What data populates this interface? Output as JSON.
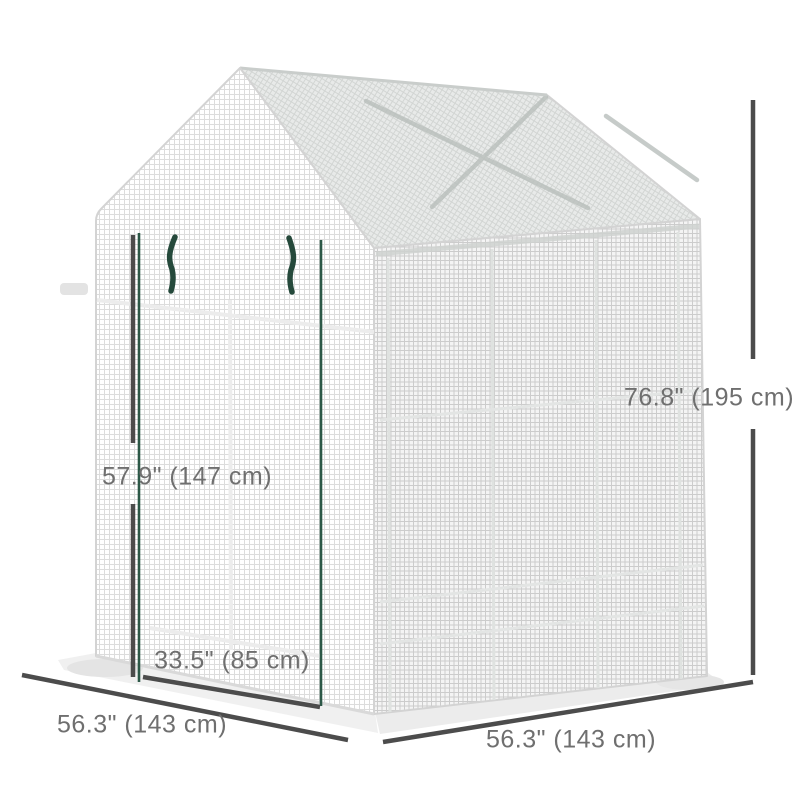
{
  "meta": {
    "title": "Walk-in greenhouse dimension diagram",
    "background": "#ffffff"
  },
  "product": {
    "name": "walk-in-greenhouse",
    "description": "White mesh walk-in greenhouse with peaked roof and double-zipper roll-up front door",
    "cover_color": "#ffffff",
    "zipper_color": "#2c5847"
  },
  "dimensions": {
    "overall_height": "76.8\" (195 cm)",
    "door_height": "57.9\" (147 cm)",
    "door_width": "33.5\" (85 cm)",
    "front_width": "56.3\" (143 cm)",
    "side_depth": "56.3\" (143 cm)"
  },
  "style": {
    "dimension_line_color": "#4c4c4c",
    "label_color": "#6f6f6f",
    "mesh_line_color": "#dcdcdc",
    "side_mesh_line_color": "#cccccc",
    "roof_shade_color": "#e8eae9"
  }
}
